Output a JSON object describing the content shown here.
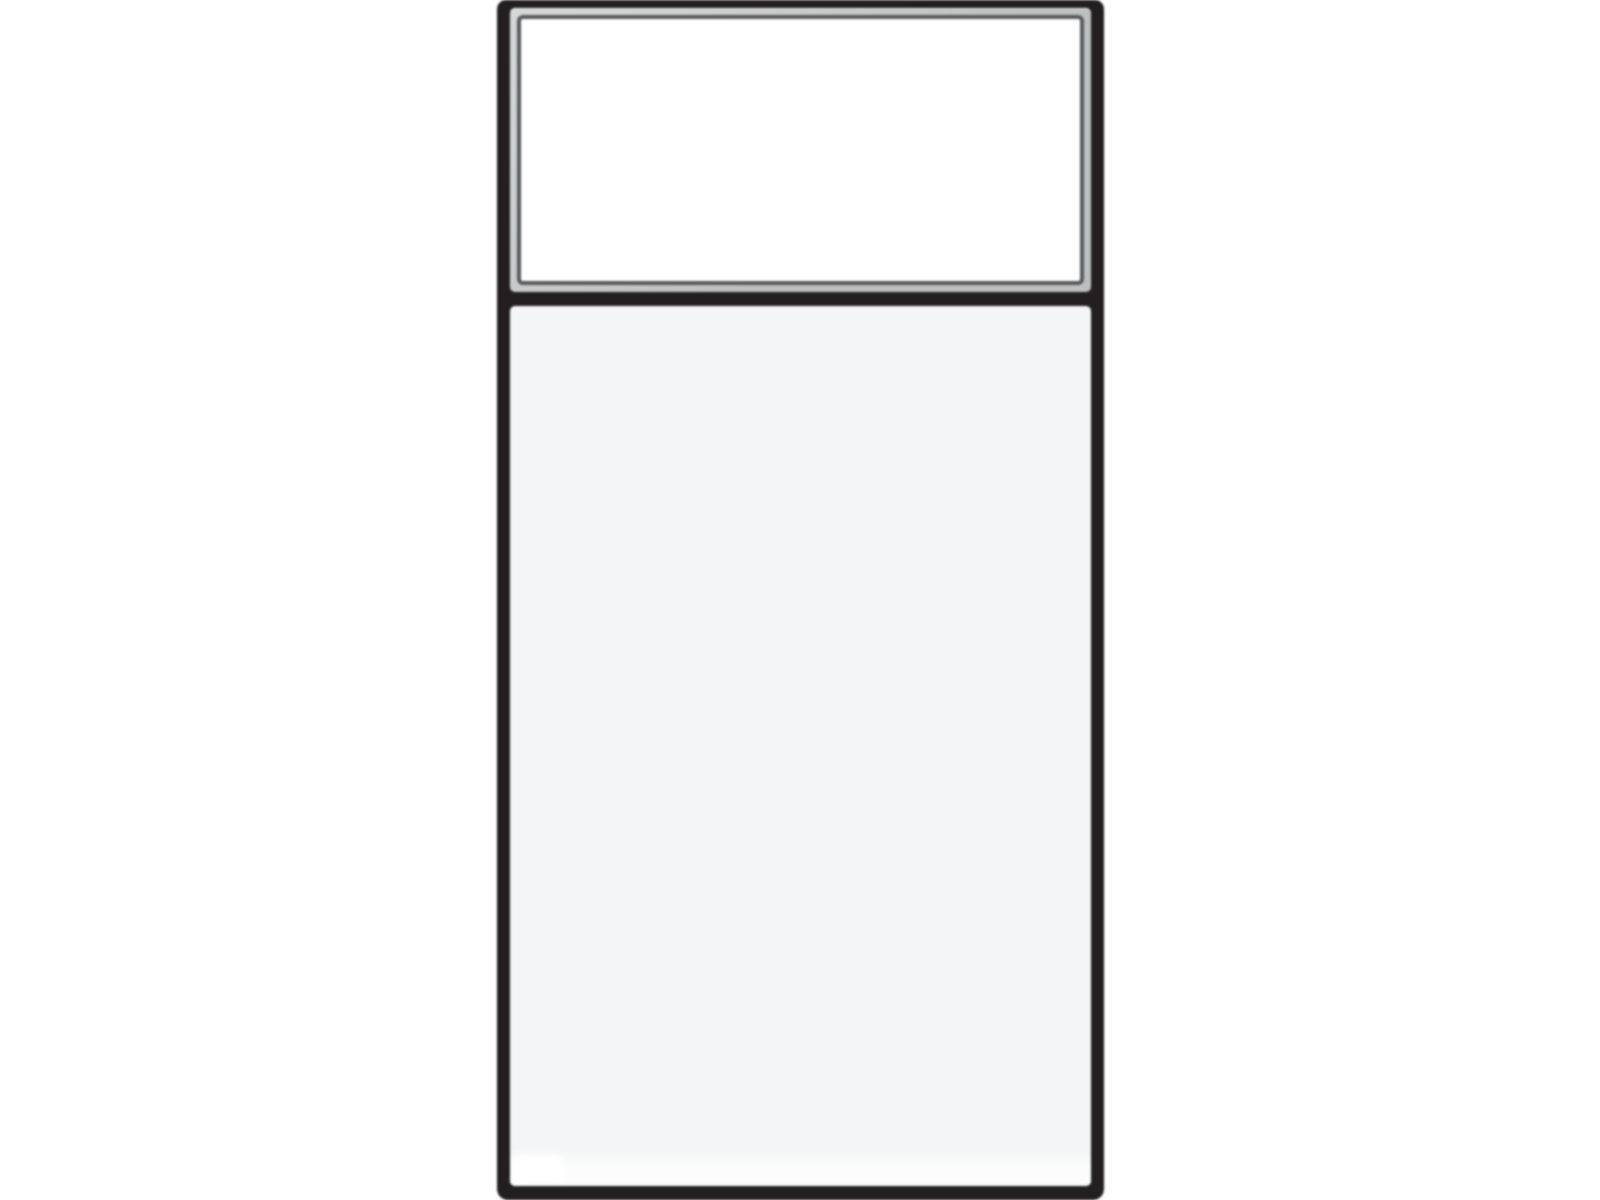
{
  "illustration": {
    "subject": "cabinet-front-with-drawer-and-door",
    "sections": {
      "drawer_front": "raised white drawer panel with beveled gray frame and thin dark outline",
      "door": "flat light-gray slab door panel with subtle bottom reflection"
    }
  },
  "colors": {
    "background": "#ffffff",
    "frame": "#231f20",
    "bevel": "#bdbfc1",
    "bevel_light": "#d6d7d8",
    "outline": "#57585a",
    "drawer_face": "#ffffff",
    "door_face": "#f4f5f6",
    "door_highlight": "#ffffff"
  }
}
